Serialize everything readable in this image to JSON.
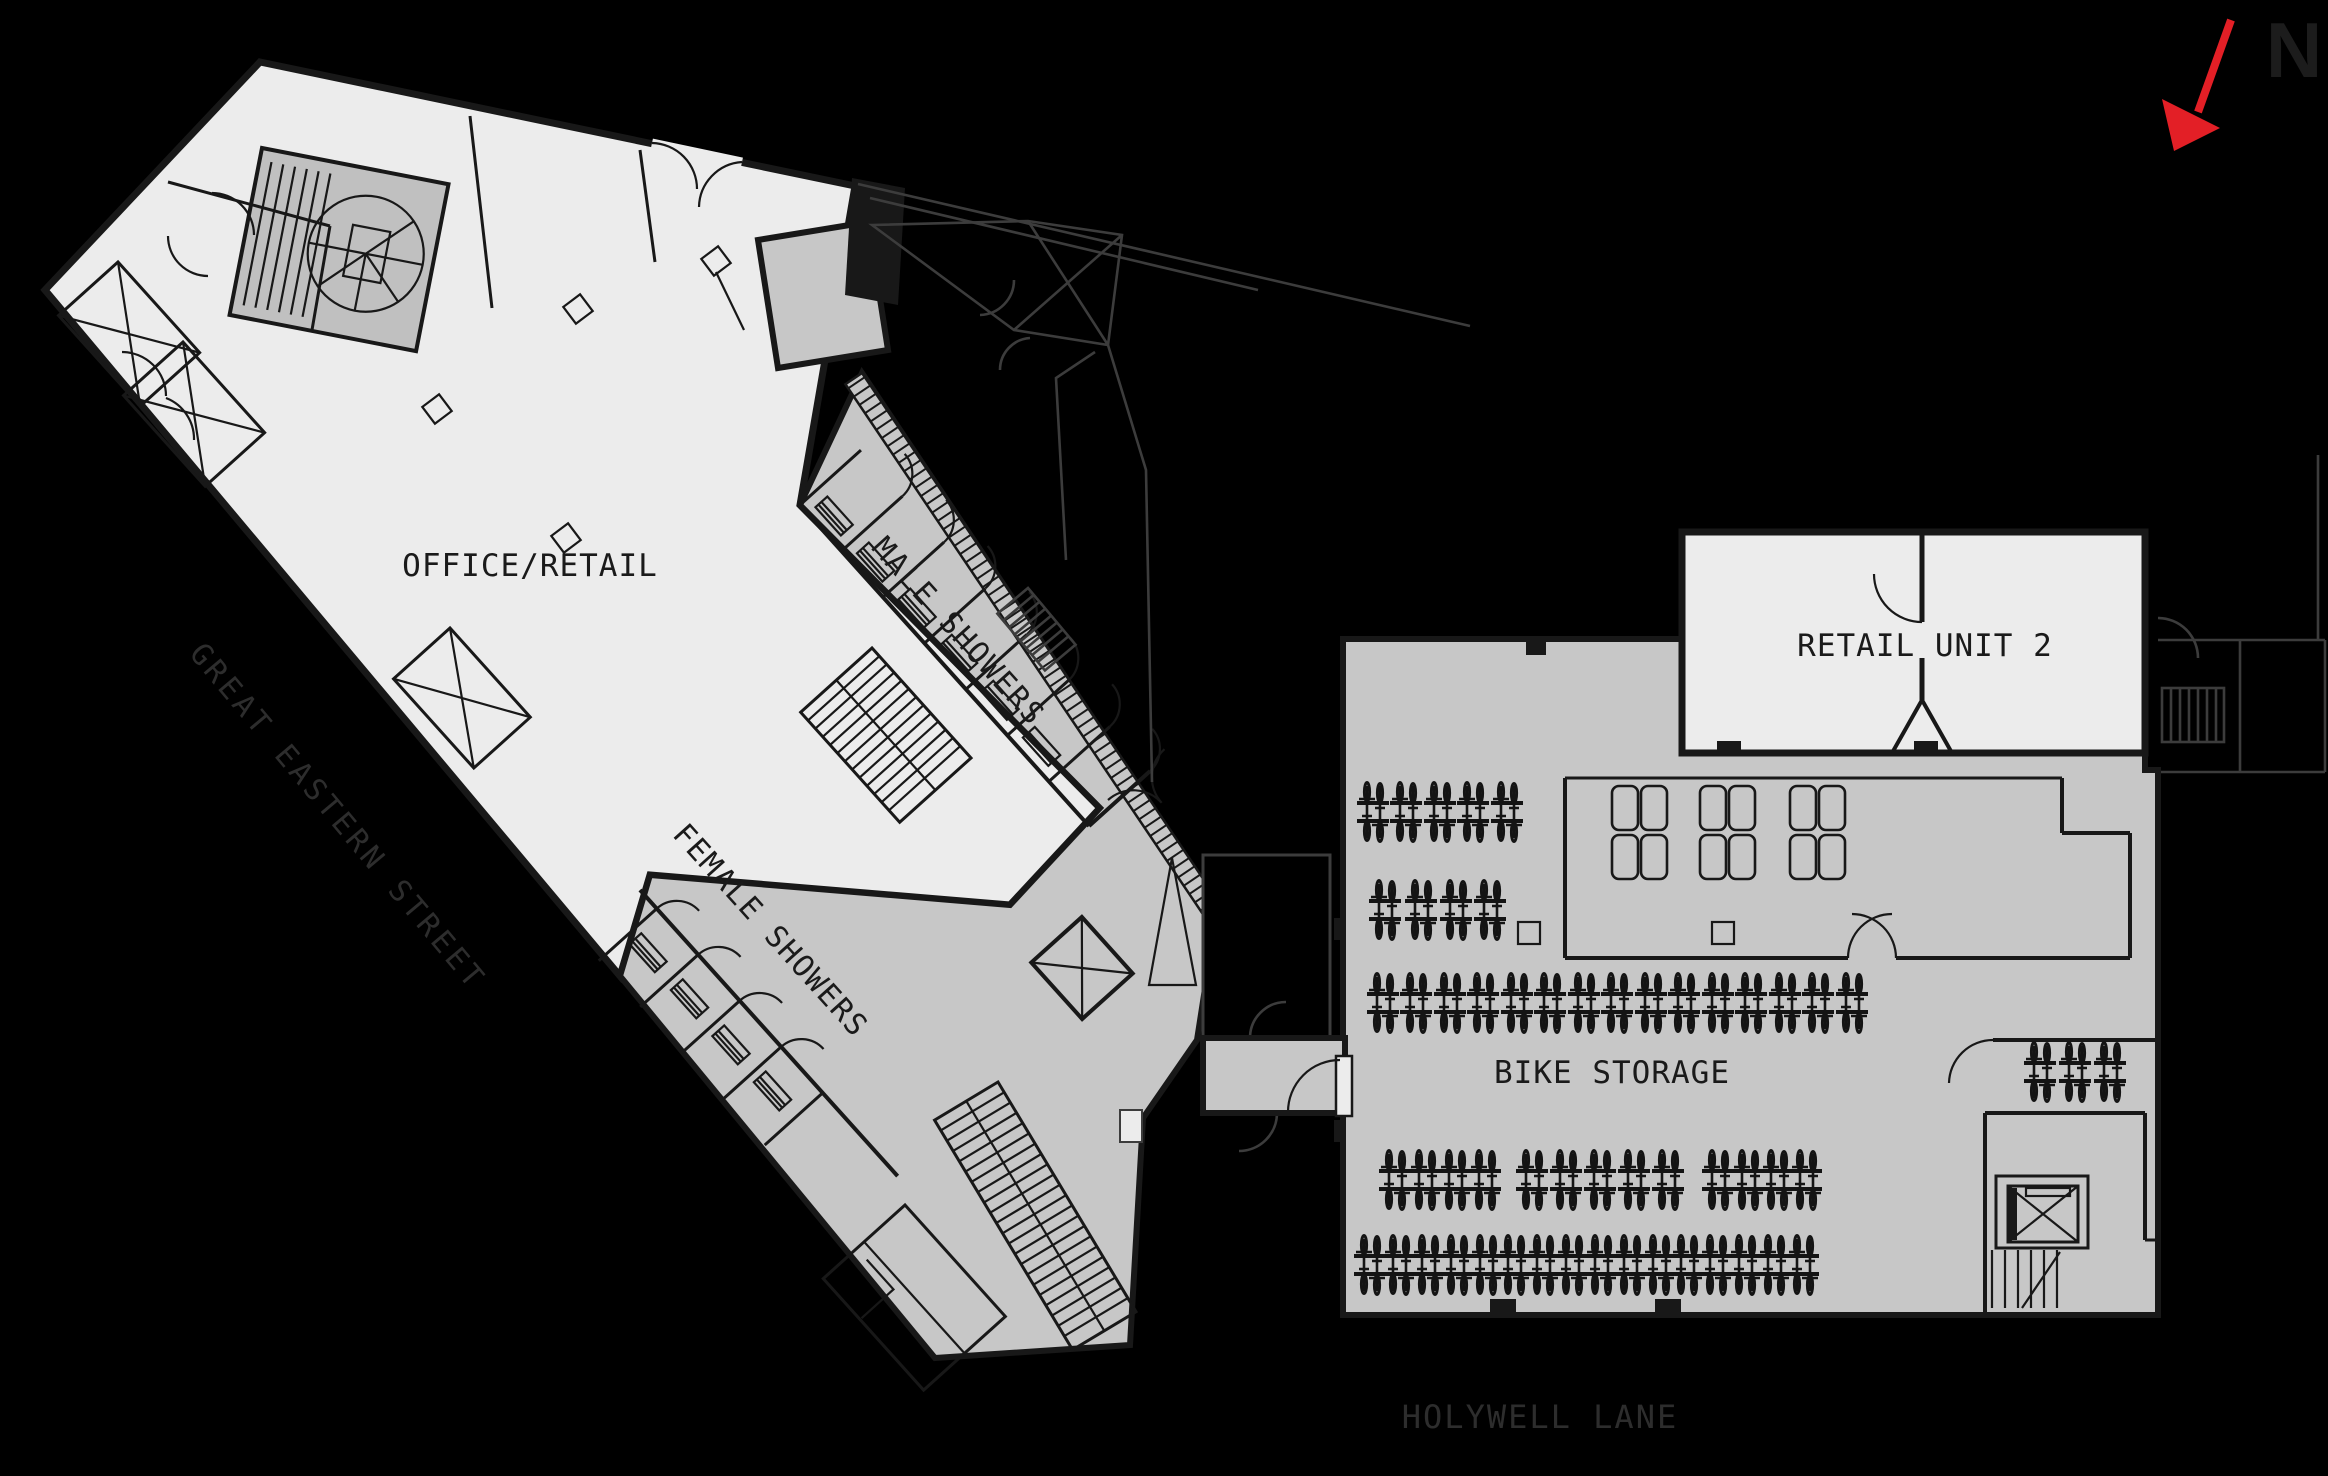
{
  "labels": {
    "office_retail": "OFFICE/RETAIL",
    "male_showers": "MALE SHOWERS",
    "female_showers": "FEMALE SHOWERS",
    "retail_unit_2": "RETAIL UNIT 2",
    "bike_storage": "BIKE STORAGE",
    "street_west": "GREAT EASTERN STREET",
    "street_south": "HOLYWELL LANE",
    "north_letter": "N"
  },
  "colors": {
    "background": "#000000",
    "floor_light": "#ececec",
    "floor_mid": "#c7c7c7",
    "stair_core": "#c0c0c0",
    "wall": "#181818",
    "context_line": "#3c3c3c",
    "street_text": "#2d2d2d",
    "north_arrow_red": "#e31f26",
    "north_letter": "#1c1c1c"
  },
  "bike_racks": {
    "rows": [
      {
        "y": 812,
        "xs": [
          1373,
          1406,
          1440,
          1473,
          1507
        ]
      },
      {
        "y": 910,
        "xs": [
          1385,
          1421,
          1456,
          1490
        ]
      },
      {
        "y": 1003,
        "xs": [
          1383,
          1416,
          1450,
          1483,
          1517,
          1550,
          1584,
          1617,
          1651,
          1684,
          1718,
          1751,
          1785,
          1818,
          1852
        ]
      },
      {
        "y": 1180,
        "xs": [
          1395,
          1425,
          1455,
          1485,
          1532,
          1566,
          1600,
          1634,
          1668,
          1718,
          1748,
          1777,
          1806
        ]
      },
      {
        "y": 1265,
        "xs": [
          1370,
          1399,
          1428,
          1457,
          1486,
          1514,
          1543,
          1572,
          1601,
          1630,
          1659,
          1687,
          1716,
          1745,
          1774,
          1803
        ]
      },
      {
        "y": 1072,
        "xs": [
          2040,
          2075,
          2110
        ]
      }
    ]
  },
  "lockers": {
    "cluster_xs": [
      1612,
      1700,
      1790
    ],
    "y": 786,
    "unit_w": 26,
    "unit_h": 44,
    "gap_x": 29,
    "gap_y": 49
  },
  "shower_stalls": {
    "male": 6,
    "female": 4
  }
}
